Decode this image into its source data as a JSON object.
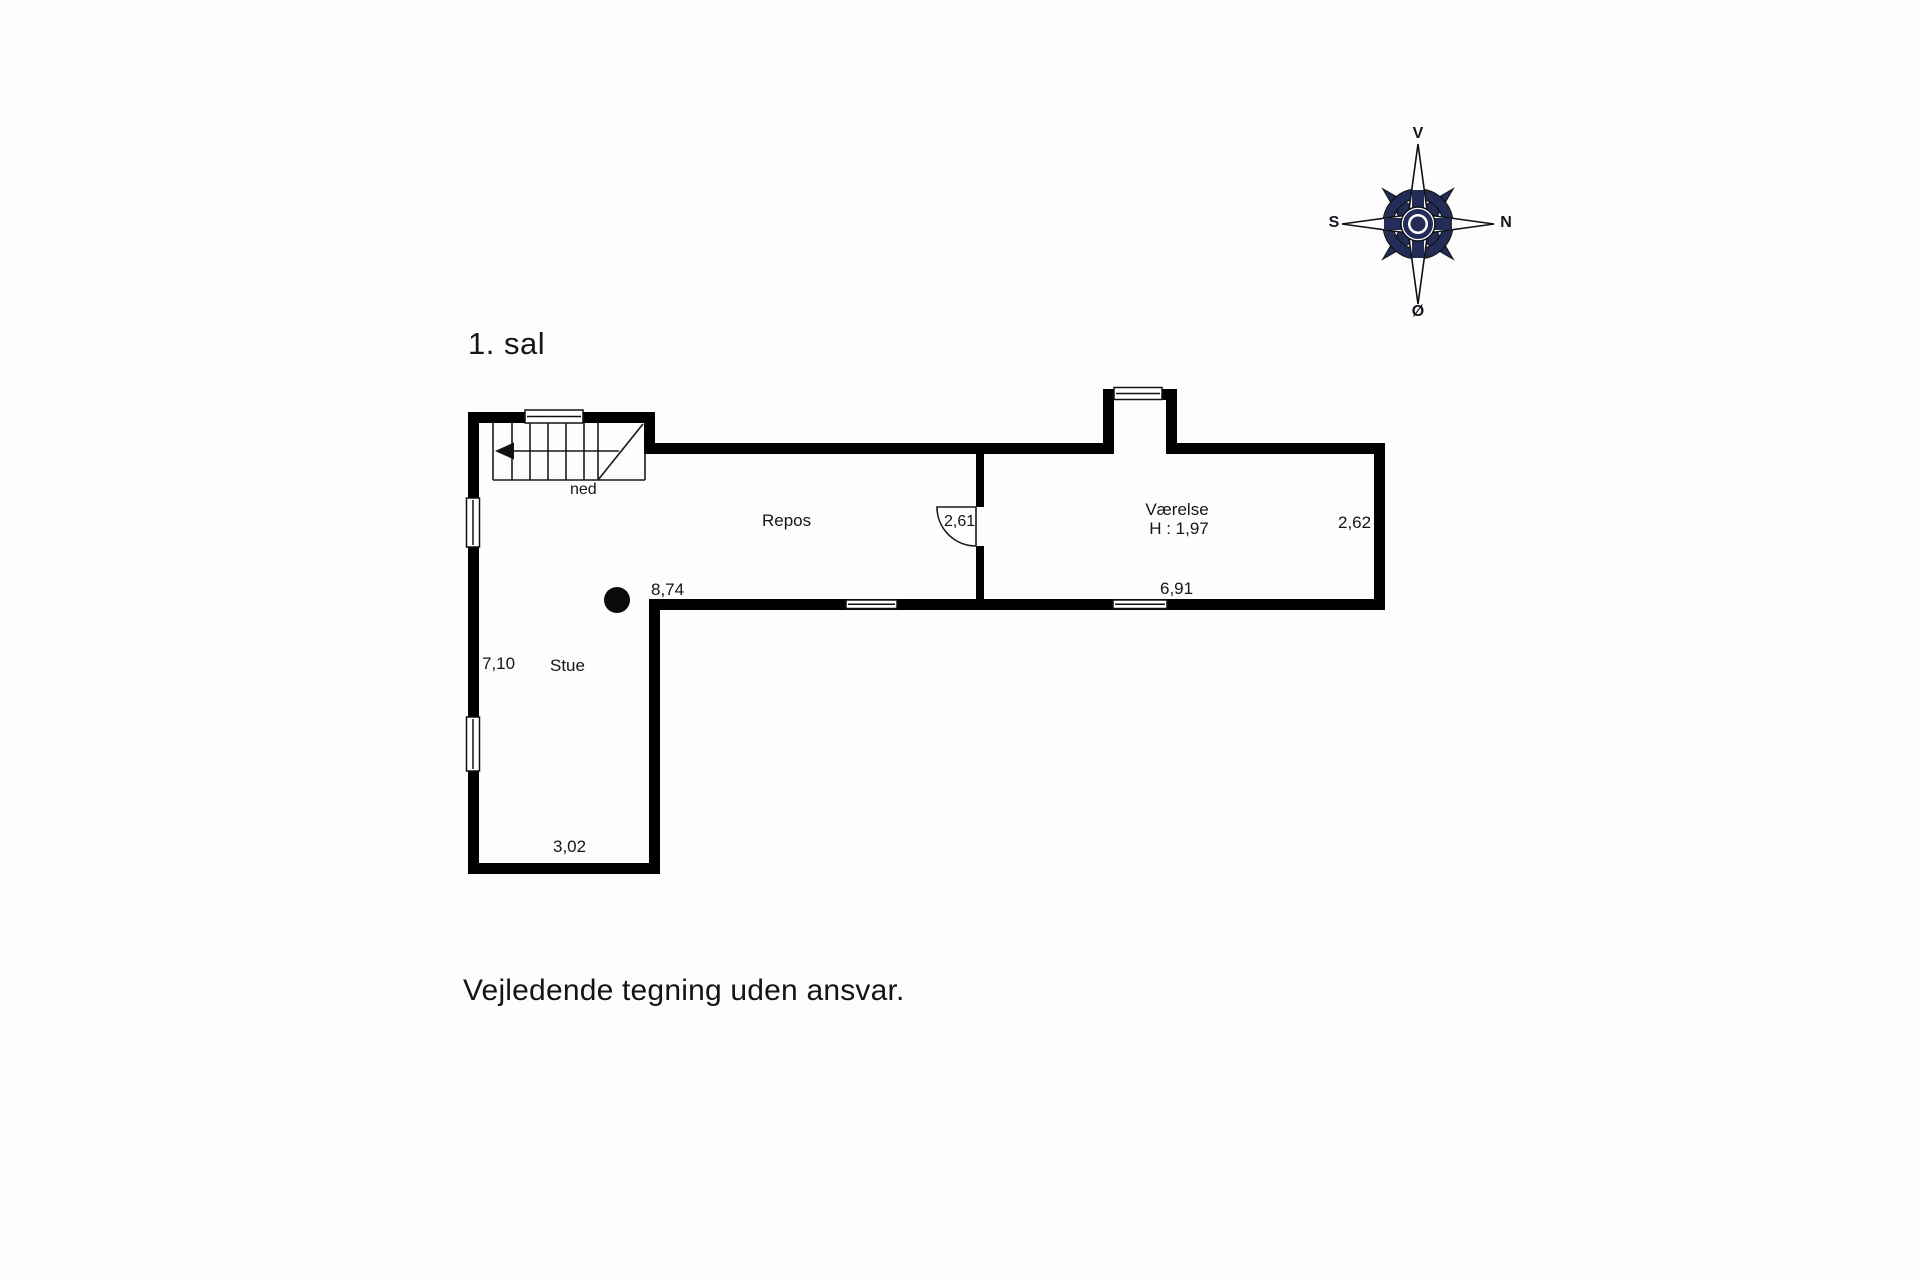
{
  "title": "1. sal",
  "disclaimer": "Vejledende tegning uden ansvar.",
  "compass": {
    "top": "V",
    "right": "N",
    "left": "S",
    "bottom": "Ø"
  },
  "plan": {
    "rooms": {
      "stue": "Stue",
      "repos": "Repos",
      "vaerelse": "Værelse",
      "vaerelse_ceiling_height": "H : 1,97"
    },
    "stairs_label": "ned",
    "dimensions": {
      "repos_width": "8,74",
      "stue_depth": "7,10",
      "stue_width": "3,02",
      "repos_door": "2,61",
      "vaerelse_width": "6,91",
      "vaerelse_depth": "2,62"
    }
  },
  "colors": {
    "walls": "#000000",
    "thin_lines": "#1a1a1a",
    "compass_navy": "#222c56",
    "background": "#fdfdfd"
  }
}
